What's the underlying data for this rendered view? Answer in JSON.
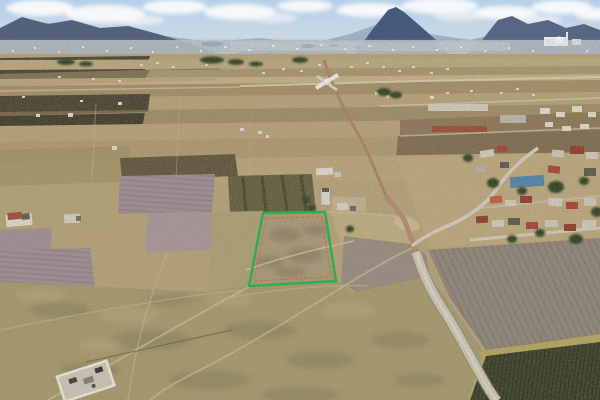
{
  "palette": {
    "sky_top": "#b4d0e8",
    "sky_bottom": "#d6dee2",
    "cloud": "#f6f8f9",
    "mountain_far": "#92a6bb",
    "mountain_left": "#53627a",
    "mountain_mid": "#64748c",
    "volcano": "#475a7c",
    "mountain_right": "#566783",
    "city_haze": "#b6c1cb",
    "plain": "#b2a078",
    "grass": "#a3976b",
    "plow_purple": "#9c8c93",
    "plow_gray": "#8d8379",
    "cleared_gray": "#958a7e",
    "cornfield": "#3a4128",
    "village_tan": "#b5a67e",
    "road_dirt": "#a87e62",
    "road_gravel": "#c9c3b4"
  },
  "parcel_highlight": {
    "points": "263,213 325,212 336,281 249,286",
    "stroke": "#2fae4e",
    "inner_points": "266,218 322,217 331,277 254,281",
    "inner_stroke": "#c4574a"
  }
}
